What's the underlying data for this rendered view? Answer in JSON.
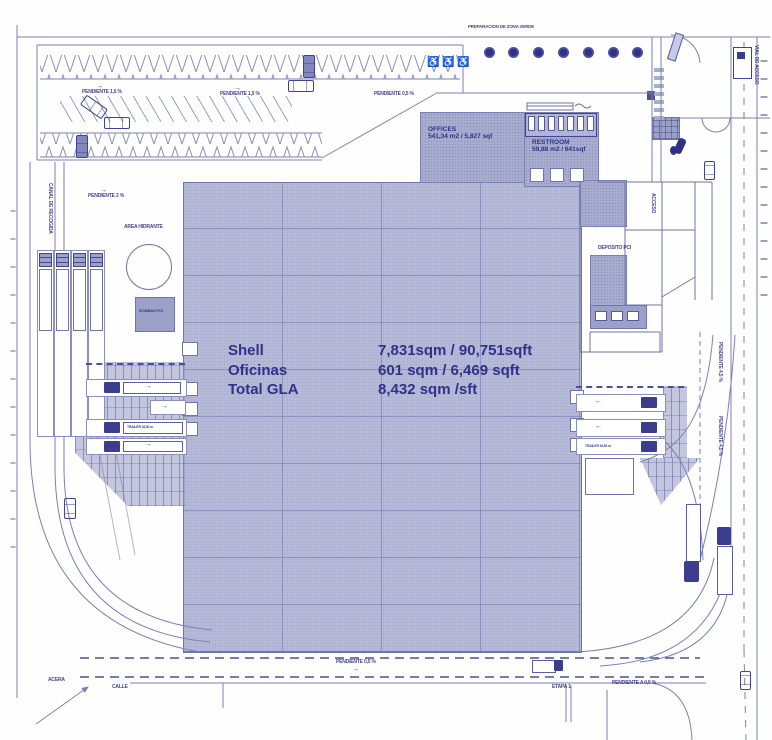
{
  "colors": {
    "line": "#7b80b4",
    "building_fill": "#b6b9d7",
    "block_fill": "#a9add0",
    "dark": "#3a3e8c",
    "text": "#2f3288",
    "tree": "#3f4390",
    "background": "#ffffff"
  },
  "summary": {
    "rows": [
      {
        "label": "Shell",
        "value": "7,831sqm / 90,751sqft"
      },
      {
        "label": "Oficinas",
        "value": "601 sqm / 6,469 sqft"
      },
      {
        "label": "Total GLA",
        "value": "8,432 sqm /sft"
      }
    ]
  },
  "rooms": {
    "offices_name": "OFFICES",
    "offices_area": "541,34 m2 / 5,827 sqf",
    "restroom_name": "RESTROOM",
    "restroom_area": "59,88 m2 / 641sqf"
  },
  "symbols": {
    "accessible": "♿",
    "arrow_right": "→",
    "arrow_left": "←"
  },
  "micro_labels": {
    "green_zone": "PREPARACION DE ZONA VERDE",
    "slope_a": "PENDIENTE 1,5 %",
    "slope_b": "PENDIENTE 1,5 %",
    "slope_c": "PENDIENTE 0,5 %",
    "slope_d": "PENDIENTE 2 %",
    "slope_e": "PENDIENTE 0,5 %",
    "slope_f": "PENDIENTE A 0,5 %",
    "slope_g": "PENDIENTE 4,5 %",
    "slope_h": "PENDIENTE 4,5 %",
    "canal": "CANAL DE RECOGIDA",
    "hydrant": "AREA HIDRANTE",
    "pump": "BOMBAS PCI",
    "deposit": "DEPOSITO PCI",
    "sidewalk": "ACERA",
    "street": "CALLE",
    "trailer_a": "TRAILER 16,50 m",
    "trailer_b": "TRAILER 16,50 m",
    "stage": "ETAPA 1",
    "access": "VIAL DE ACCESO",
    "entry": "ACCESO"
  }
}
